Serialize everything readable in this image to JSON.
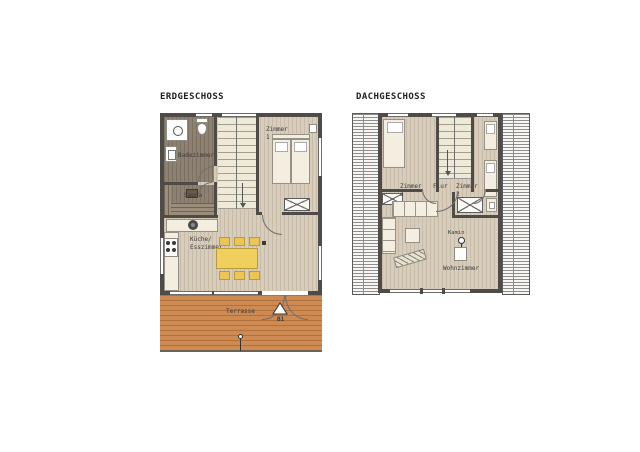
{
  "page": {
    "background": "#ffffff"
  },
  "colors": {
    "wall": "#4f4b47",
    "wood_floor": "#d7cdbd",
    "bath_floor": "#8d8173",
    "stair_floor": "#efe9d8",
    "terrace_wood": "#cd8a52",
    "table_yellow": "#f0cf5e",
    "roof_hatch": "#f7f6f2"
  },
  "erdgeschoss": {
    "title": "ERDGESCHOSS",
    "rooms": {
      "badezimmer": "Badezimmer",
      "sauna": "Sauna",
      "zimmer1": "Zimmer 1",
      "kueche": "Küche/\nEsszimmer",
      "terrasse": "Terrasse"
    },
    "marker": {
      "label": "B1"
    }
  },
  "dachgeschoss": {
    "title": "DACHGESCHOSS",
    "rooms": {
      "zimmer3": "Zimmer 3",
      "flur": "Flur",
      "zimmer2": "Zimmer 2",
      "kamin": "Kamin",
      "wohnzimmer": "Wohnzimmer"
    }
  }
}
